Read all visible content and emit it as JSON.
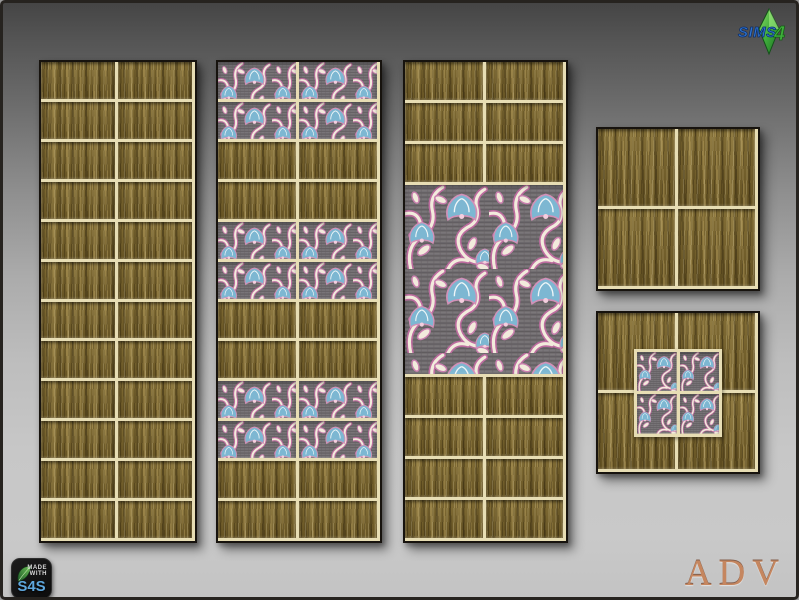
{
  "page": {
    "background_top": "#454545",
    "background_bottom": "#c9c9c9",
    "grout_color": "#e7ddb4",
    "panel_border_color": "#17130e"
  },
  "palette": {
    "gold_base": "#75612b",
    "floral_background": "#716d70",
    "floral_vine": "#f2ebdc",
    "floral_outline": "#bd6b9f",
    "floral_flower_blue": "#7db7d2"
  },
  "branding": {
    "sims_logo": {
      "word": "SIMS",
      "number": "4",
      "word_color": "#2f74cf",
      "number_color": "#3fae3b",
      "plumbob_color": "#4db83e"
    },
    "made_with_badge": {
      "line1": "MADE",
      "line2": "WITH",
      "label": "S4S",
      "label_color": "#5ea7dd"
    },
    "watermark": {
      "text": "ADV",
      "color": "#c5865f"
    }
  },
  "swatches": {
    "panels": [
      {
        "name": "tall-gold-panel",
        "x": 36,
        "y": 57,
        "w": 158,
        "h": 483,
        "rows": [
          {
            "h": 40,
            "cells": [
              "gold",
              "gold"
            ],
            "repeat": 12
          }
        ]
      },
      {
        "name": "tall-floral-stripe-panel",
        "x": 213,
        "y": 57,
        "w": 166,
        "h": 483,
        "rows": [
          {
            "h": 40,
            "cells": [
              "floral",
              "floral"
            ],
            "repeat": 2
          },
          {
            "h": 40,
            "cells": [
              "gold",
              "gold"
            ],
            "repeat": 2
          },
          {
            "h": 40,
            "cells": [
              "floral",
              "floral"
            ],
            "repeat": 2
          },
          {
            "h": 40,
            "cells": [
              "gold",
              "gold"
            ],
            "repeat": 2
          },
          {
            "h": 40,
            "cells": [
              "floral",
              "floral"
            ],
            "repeat": 2
          },
          {
            "h": 40,
            "cells": [
              "gold",
              "gold"
            ],
            "repeat": 2
          }
        ]
      },
      {
        "name": "tall-gold-mural-panel",
        "x": 400,
        "y": 57,
        "w": 165,
        "h": 483,
        "rows": [
          {
            "h": 40,
            "cells": [
              "gold",
              "gold"
            ],
            "repeat": 3
          },
          {
            "h": 200,
            "cells": [
              "mural"
            ],
            "repeat": 1
          },
          {
            "h": 40,
            "cells": [
              "gold",
              "gold"
            ],
            "repeat": 4
          }
        ]
      },
      {
        "name": "square-gold-panel",
        "x": 593,
        "y": 124,
        "w": 164,
        "h": 164,
        "rows": [
          {
            "h": 80,
            "cells": [
              "gold",
              "gold"
            ],
            "repeat": 2
          }
        ]
      },
      {
        "name": "square-gold-floral-inset-panel",
        "x": 593,
        "y": 308,
        "w": 164,
        "h": 163,
        "rows": [
          {
            "h": 80,
            "cells": [
              "gold",
              "gold"
            ],
            "repeat": 2
          }
        ],
        "inset": {
          "size": 88,
          "rows": 2,
          "cols": 2,
          "type": "floral-xs"
        }
      }
    ]
  }
}
